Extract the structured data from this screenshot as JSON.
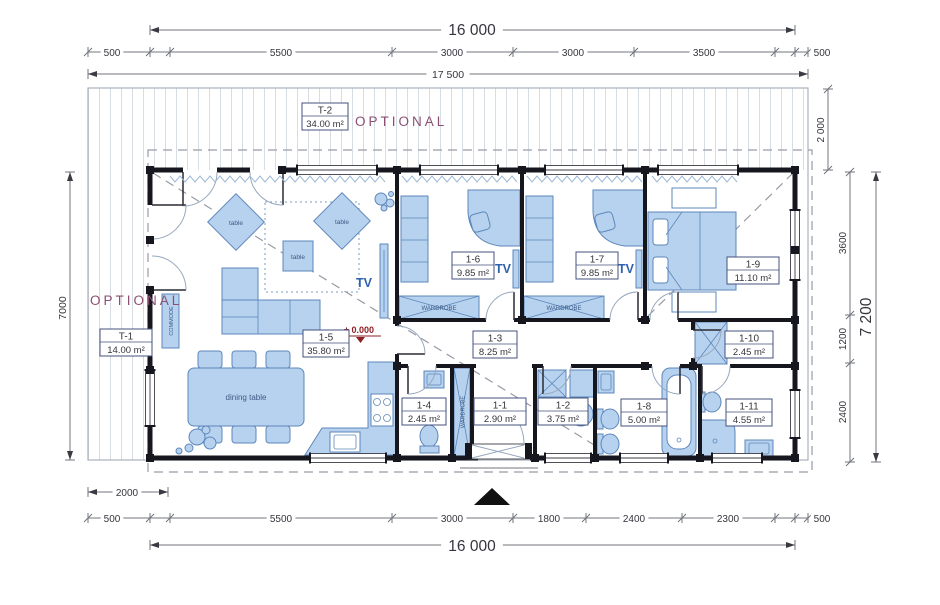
{
  "annotations": {
    "optional": "OPTIONAL",
    "level": "± 0.000"
  },
  "dimensions": {
    "top": {
      "overall": "16 000",
      "segments": [
        "500",
        "5500",
        "3000",
        "3000",
        "3500",
        "500"
      ],
      "total": "17 500"
    },
    "bottom": {
      "porch": "2000",
      "segments": [
        "500",
        "5500",
        "3000",
        "1800",
        "2400",
        "2300",
        "500"
      ],
      "overall": "16 000"
    },
    "left": {
      "overall": "7000"
    },
    "right": {
      "overhang": "2 000",
      "segments": [
        "3600",
        "1200",
        "2400"
      ],
      "overall": "7 200"
    }
  },
  "rooms": {
    "t1": {
      "id": "T-1",
      "area": "14.00 m²"
    },
    "t2": {
      "id": "T-2",
      "area": "34.00 m²"
    },
    "r1_1": {
      "id": "1-1",
      "area": "2.90 m²"
    },
    "r1_2": {
      "id": "1-2",
      "area": "3.75 m²"
    },
    "r1_3": {
      "id": "1-3",
      "area": "8.25 m²"
    },
    "r1_4": {
      "id": "1-4",
      "area": "2.45 m²"
    },
    "r1_5": {
      "id": "1-5",
      "area": "35.80 m²"
    },
    "r1_6": {
      "id": "1-6",
      "area": "9.85 m²"
    },
    "r1_7": {
      "id": "1-7",
      "area": "9.85 m²"
    },
    "r1_8": {
      "id": "1-8",
      "area": "5.00 m²"
    },
    "r1_9": {
      "id": "1-9",
      "area": "11.10 m²"
    },
    "r1_10": {
      "id": "1-10",
      "area": "2.45 m²"
    },
    "r1_11": {
      "id": "1-11",
      "area": "4.55 m²"
    }
  },
  "furniture_labels": {
    "table": "table",
    "dining_table": "dining table",
    "commode": "COMMODE",
    "wardrobe": "WARDROBE",
    "tv": "TV"
  },
  "colors": {
    "wall": "#16161f",
    "furniture_fill": "#b7d2ee",
    "furniture_stroke": "#5d87bb",
    "optional_accent": "#8a4f73",
    "level_mark_red": "#8e1f24",
    "tv_label_blue": "#2f62ae",
    "dimension_text": "#35353d"
  }
}
